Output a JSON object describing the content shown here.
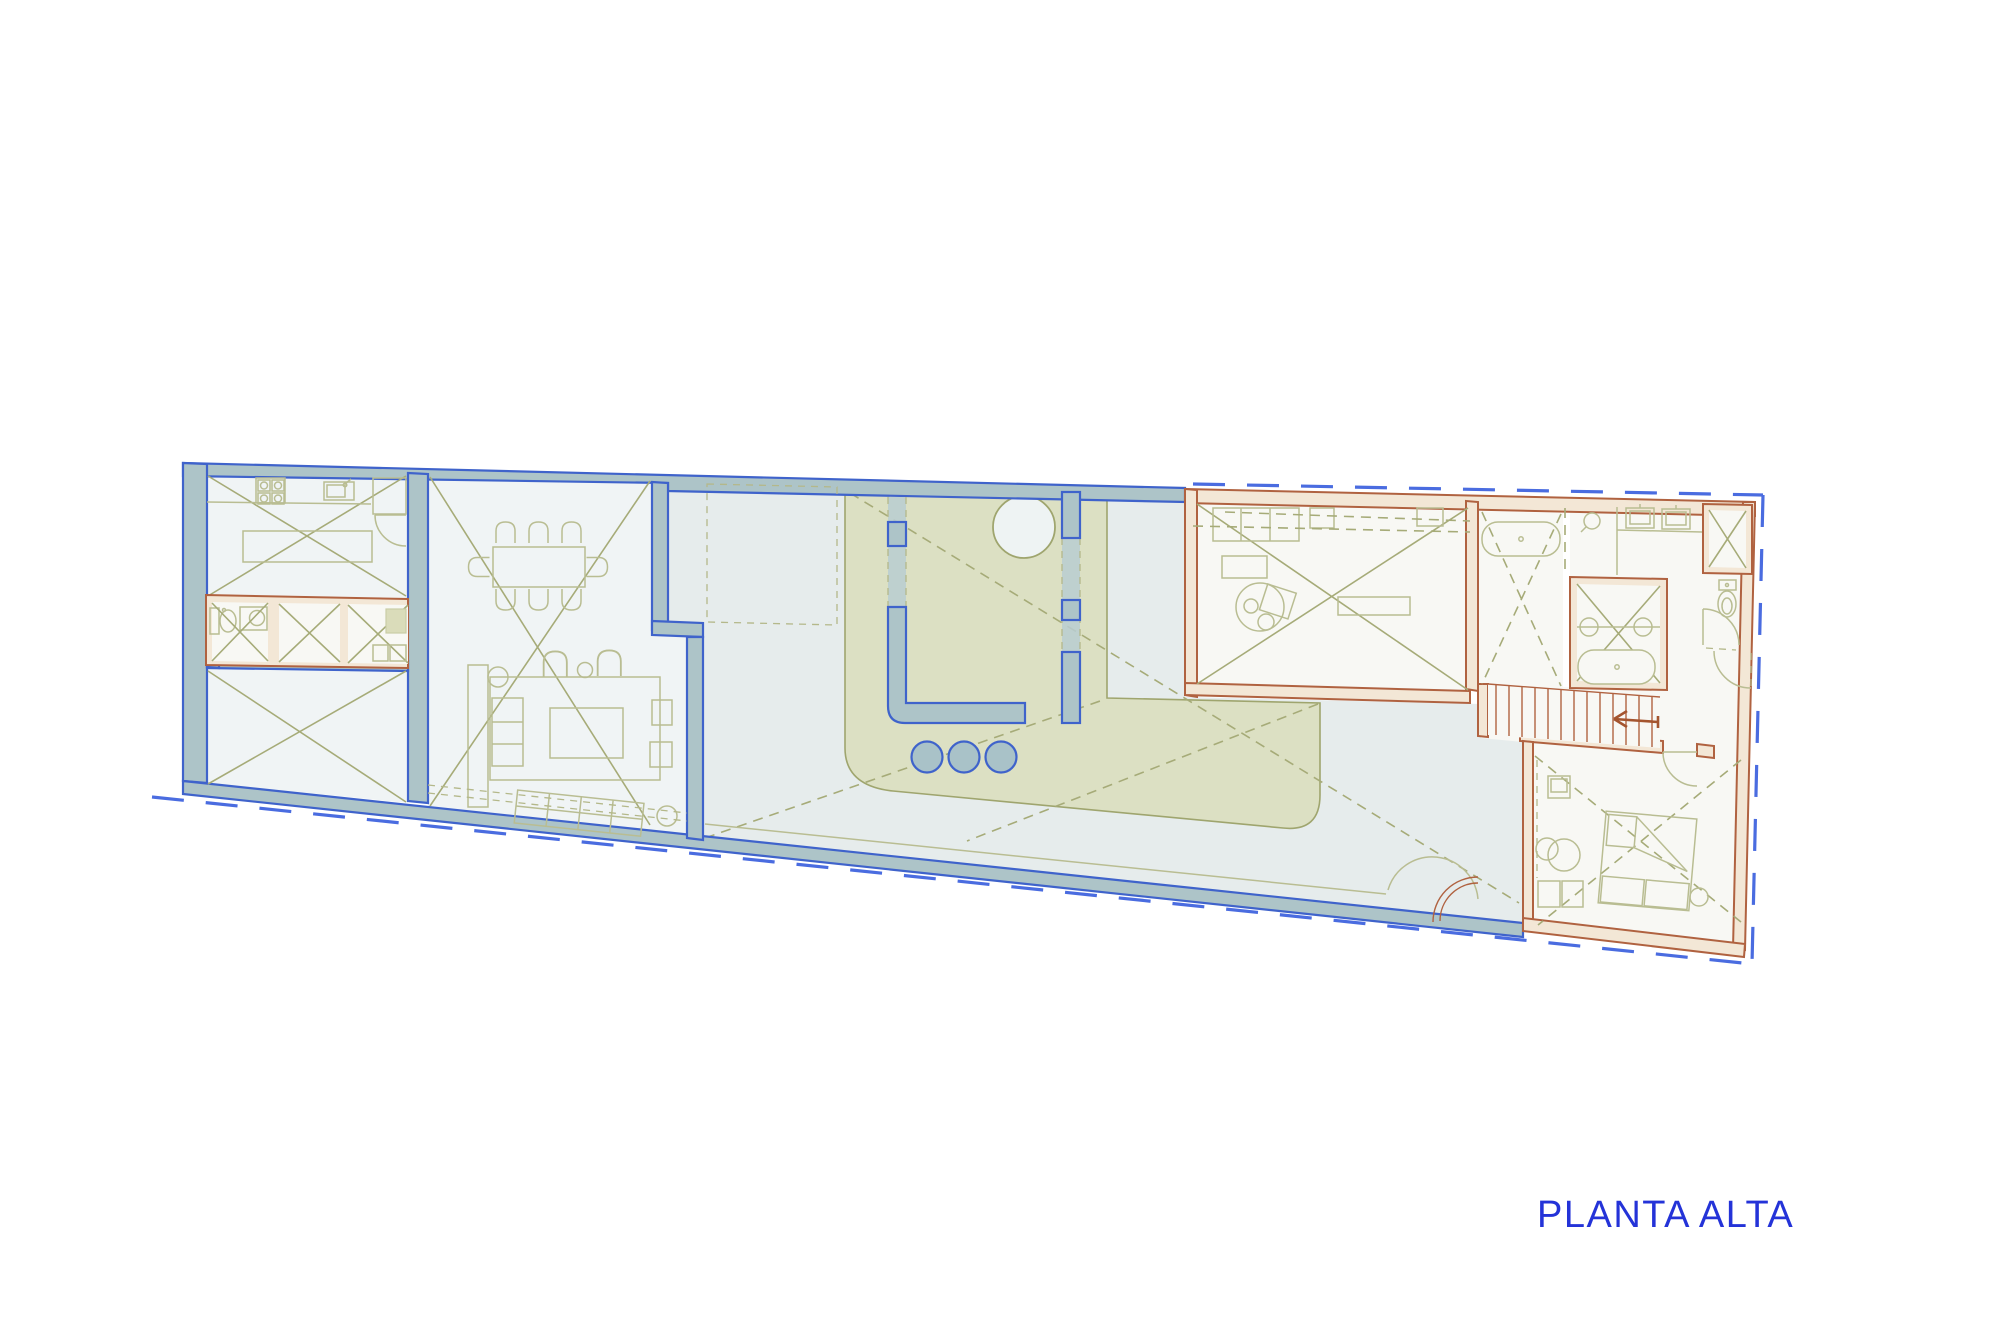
{
  "title": {
    "label": "PLANTA ALTA"
  },
  "palette": {
    "label_blue": "#2433d8",
    "wall_stroke_blue": "#3f63cb",
    "wall_fill_bluegray": "#adc4c8",
    "property_line_blue": "#4a6ce0",
    "orange_wall_stroke": "#b06240",
    "orange_wall_fill": "#f3e7d6",
    "olive_marking_line": "#a6ab78",
    "furniture_line": "#b9bd92",
    "garden_fill": "#dce0c3",
    "garden_stroke": "#9fa56e",
    "terrace_floor": "#e6ecec",
    "room_floor": "#f0f4f5",
    "wing_room_floor": "#f8f8f4"
  },
  "drawing": {
    "type": "architectural-floor-plan",
    "floor_label": "PLANTA ALTA"
  }
}
